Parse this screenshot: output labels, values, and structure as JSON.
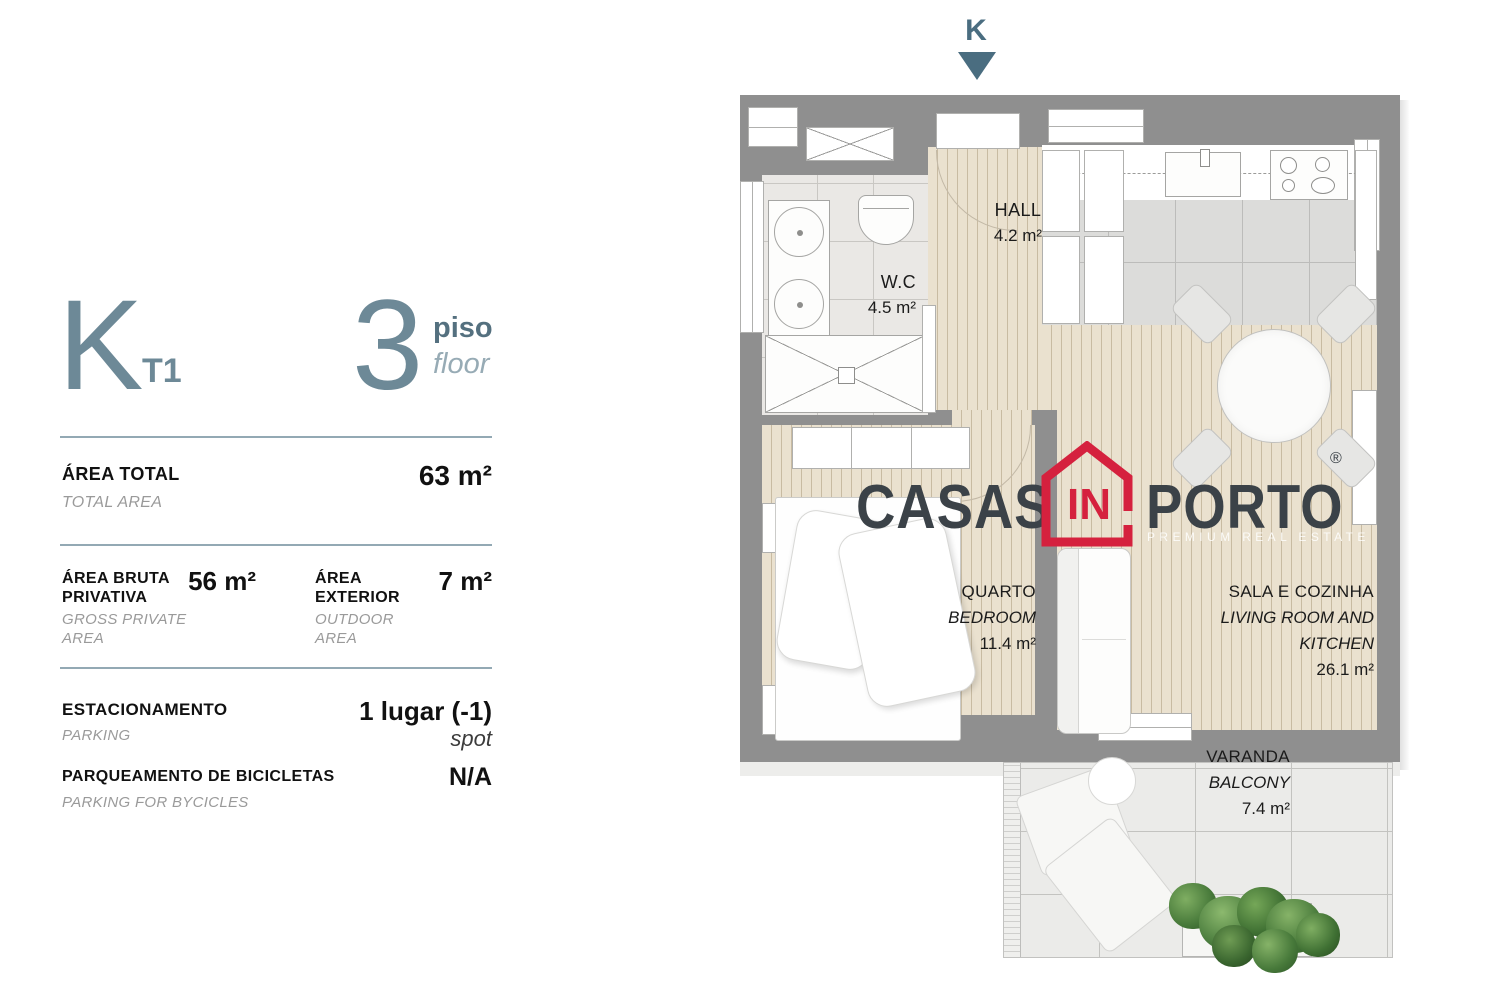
{
  "panel": {
    "unit_letter": "K",
    "unit_type": "T1",
    "floor_number": "3",
    "floor_label_pt": "piso",
    "floor_label_en": "floor",
    "area_total": {
      "label_pt": "ÁREA TOTAL",
      "label_en": "TOTAL AREA",
      "value": "63 m²"
    },
    "area_private": {
      "label_pt": "ÁREA BRUTA PRIVATIVA",
      "label_en": "GROSS PRIVATE AREA",
      "value": "56 m²"
    },
    "area_exterior": {
      "label_pt": "ÁREA EXTERIOR",
      "label_en": "OUTDOOR AREA",
      "value": "7 m²"
    },
    "parking": {
      "label_pt": "ESTACIONAMENTO",
      "label_en": "PARKING",
      "value": "1 lugar (-1)",
      "value_sub": "spot"
    },
    "bike_parking": {
      "label_pt": "PARQUEAMENTO DE BICICLETAS",
      "label_en": "PARKING FOR BYCICLES",
      "value": "N/A"
    }
  },
  "plan": {
    "orientation_marker": "K",
    "rooms": {
      "hall": {
        "name": "HALL",
        "area": "4.2 m²"
      },
      "wc": {
        "name": "W.C",
        "area": "4.5 m²"
      },
      "bedroom": {
        "name_pt": "QUARTO",
        "name_en": "BEDROOM",
        "area": "11.4 m²"
      },
      "living": {
        "name_pt": "SALA  E COZINHA",
        "name_en": "LIVING ROOM AND KITCHEN",
        "area": "26.1 m²"
      },
      "balcony": {
        "name_pt": "VARANDA",
        "name_en": "BALCONY",
        "area": "7.4 m²"
      }
    },
    "watermark": {
      "word_left": "CASAS",
      "word_mid": "IN",
      "word_right": "PORTO",
      "registered": "®",
      "tagline": "PREMIUM REAL ESTATE"
    }
  },
  "colors": {
    "accent_slate": "#6d8997",
    "wall_gray": "#8f8f8f",
    "brand_red": "#d5213e",
    "brand_dark": "#3b4248"
  }
}
